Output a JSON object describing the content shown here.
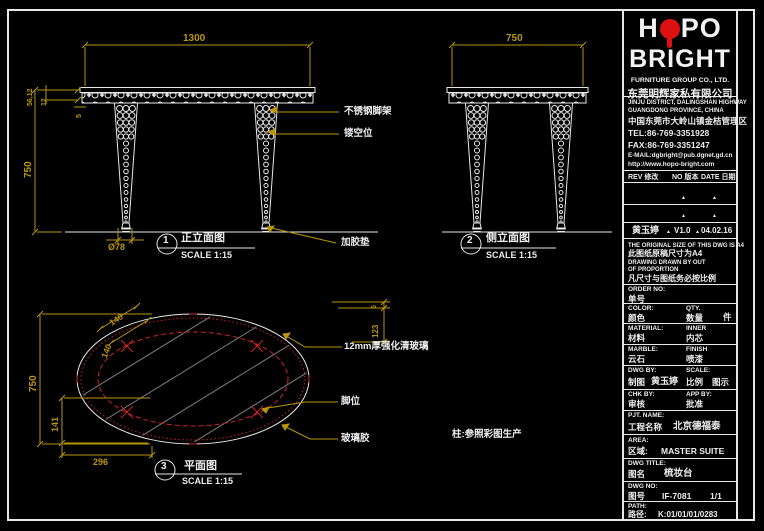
{
  "colors": {
    "background": "#000000",
    "line_white": "#e8e8e8",
    "dimension_gold": "#b8960b",
    "annotation_red": "#cc2222",
    "logo_red": "#dd1111",
    "hatch_gray": "#7d7d7d"
  },
  "views": {
    "front": {
      "marker_no": "1",
      "title": "正立面图",
      "scale": "SCALE 1:15",
      "dim_width": "1300",
      "dim_height": "750",
      "dim_top_a": "56,12",
      "dim_top_b": "12",
      "dim_top_c": "5",
      "dim_foot": "Ø78",
      "label_leg": "不锈钢脚架",
      "label_hollow": "镂空位",
      "label_pad": "加胶垫"
    },
    "side": {
      "marker_no": "2",
      "title": "侧立面图",
      "scale": "SCALE 1:15",
      "dim_width": "750"
    },
    "plan": {
      "marker_no": "3",
      "title": "平面图",
      "scale": "SCALE 1:15",
      "dim_height": "750",
      "dim_left": "141",
      "dim_bottom": "296",
      "dim_diag_a": "140",
      "dim_diag_b": "140",
      "dim_edge_a": "5",
      "dim_edge_b": "123",
      "label_glass": "12mm厚强化清玻璃",
      "label_leg_pos": "脚位",
      "label_glue": "玻璃胶",
      "note": "柱:参照彩图生产"
    }
  },
  "titleblock": {
    "logo": {
      "name_part1": "H",
      "name_part2": "PO",
      "name_line2": "BRIGHT",
      "subtitle_en": "FURNITURE GROUP CO., LTD.",
      "subtitle_cn": "东莞明辉家私有限公司"
    },
    "address": {
      "line1": "JINJU DISTRICT, DALINGSHAN HIGHWAY",
      "line2": "GUANGDONG PROVINCE, CHINA",
      "line3": "中国东莞市大岭山镇金桔管理区",
      "tel": "TEL:86-769-3351928",
      "fax": "FAX:86-769-3351247",
      "email": "E-MAIL:dgbright@pub.dgnet.gd.cn",
      "web": "http://www.hopo-bright.com"
    },
    "revision": {
      "header_rev": "REV 修改",
      "header_no": "NO 版本",
      "header_date": "DATE 日期",
      "marker": "▲",
      "entry_name": "黄玉婷",
      "entry_version": "V1.0",
      "entry_date": "04.02.16"
    },
    "notice": {
      "line1": "THE ORIGINAL SIZE OF THIS DWG IS A4",
      "line2": "此图纸原稿尺寸为A4",
      "line3": "DRAWING DRAWN BY OUT",
      "line4": "OF PROPORTION",
      "line5": "凡尺寸与图纸务必按比例"
    },
    "fields": {
      "order_en": "ORDER NO:",
      "order_cn": "单号",
      "color_en": "COLOR:",
      "color_cn": "颜色",
      "qty_en": "QTY.",
      "qty_cn": "数量",
      "qty_unit": "件",
      "material_en": "MATERIAL:",
      "material_cn": "材料",
      "inner_en": "INNER",
      "inner_cn": "内芯",
      "marble_en": "MARBLE:",
      "marble_cn": "云石",
      "finish_en": "FINISH",
      "finish_cn": "喷漆",
      "dwgby_en": "DWG BY:",
      "dwgby_cn": "制图",
      "dwgby_value": "黄玉婷",
      "scale_en": "SCALE:",
      "scale_cn": "比例",
      "scale_value": "图示",
      "chkby_en": "CHK BY:",
      "chkby_cn": "审核",
      "appby_en": "APP BY:",
      "appby_cn": "批准",
      "project_en": "PJT. NAME:",
      "project_cn": "工程名称",
      "project_value": "北京德福泰",
      "area_en": "AREA:",
      "area_cn": "区域:",
      "area_value": "MASTER SUITE",
      "dwgtitle_en": "DWG TITLE:",
      "dwgtitle_cn": "图名",
      "dwgtitle_value": "梳妆台",
      "dwgno_en": "DWG NO:",
      "dwgno_cn": "图号",
      "dwgno_value": "IF-7081",
      "dwgno_sheet": "1/1",
      "path_en": "PATH:",
      "path_cn": "路径:",
      "path_value": "K:01/01/01/0283"
    }
  }
}
